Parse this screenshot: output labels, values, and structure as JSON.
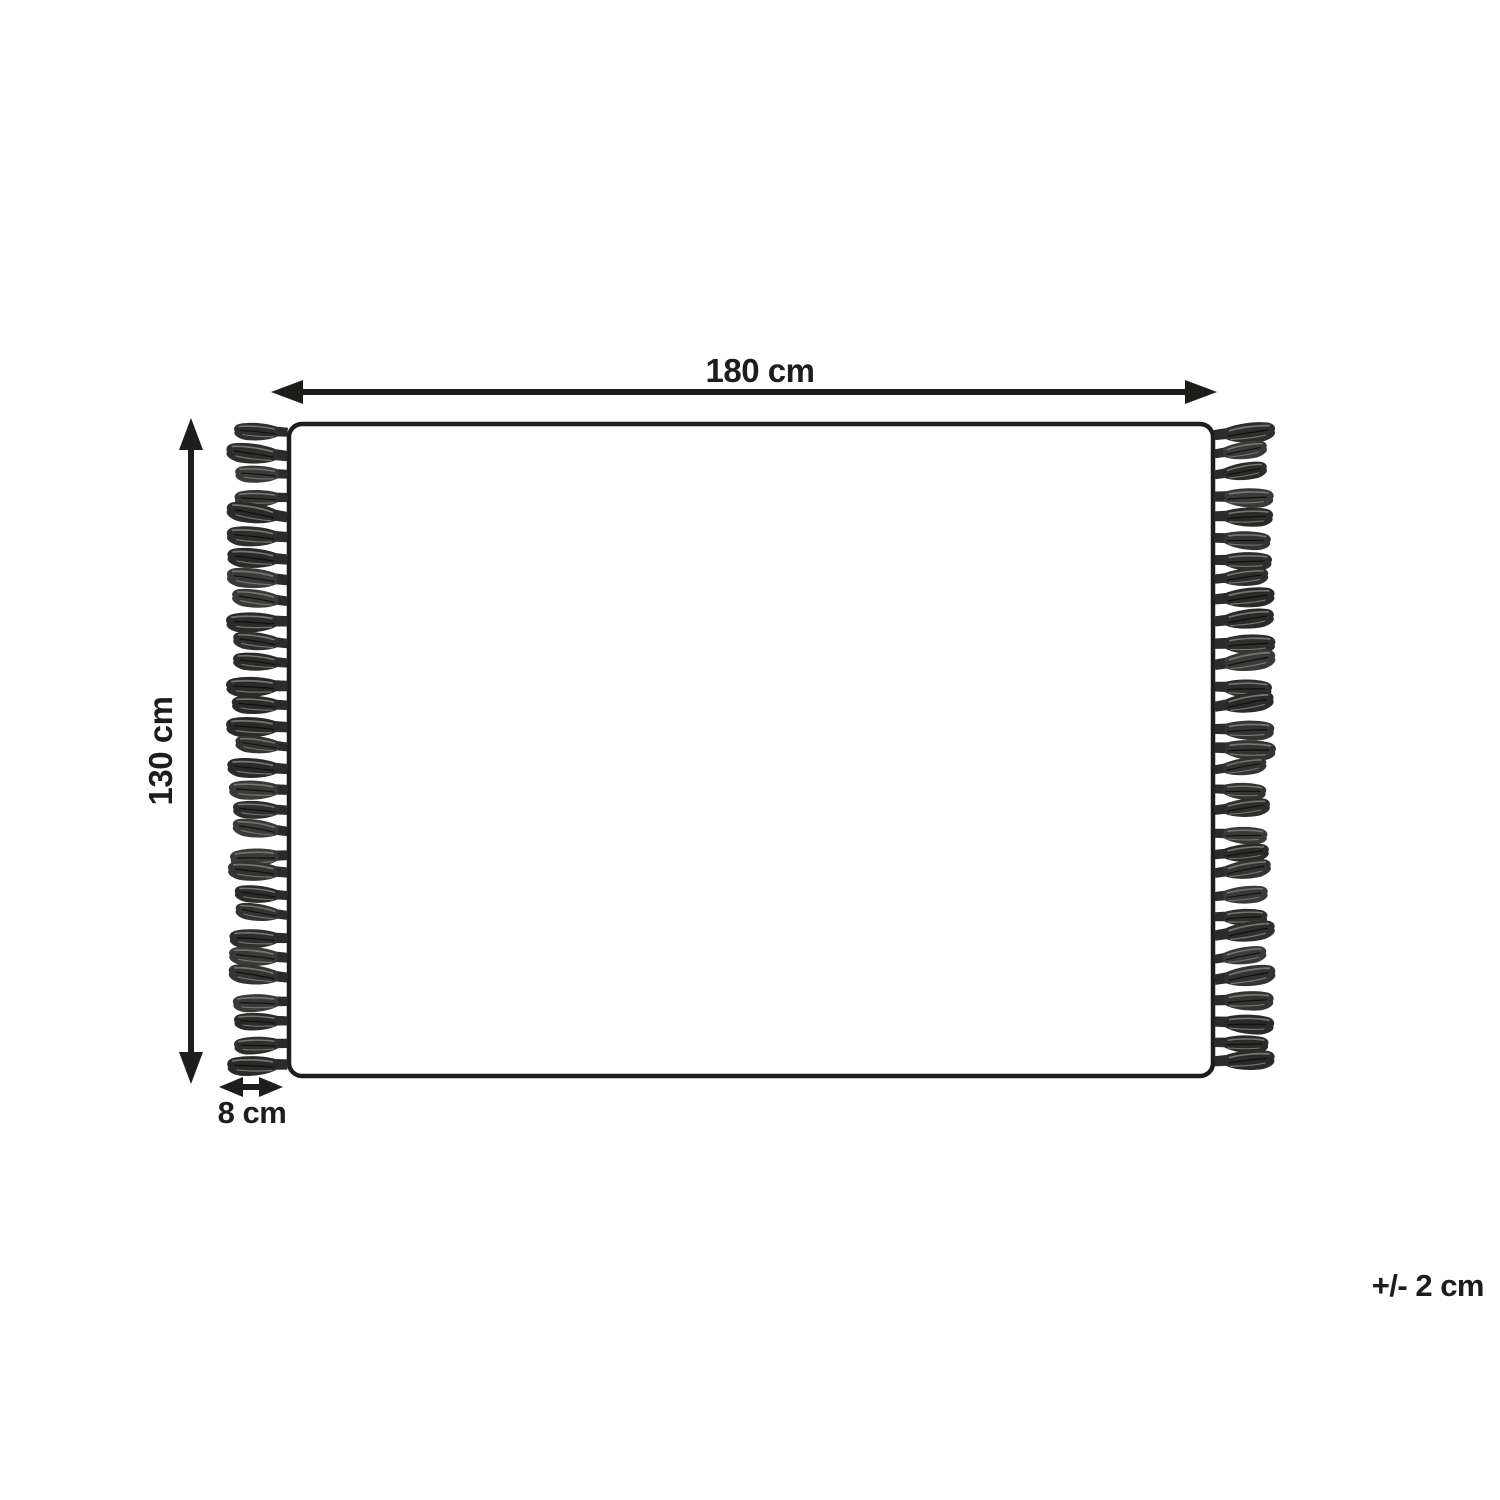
{
  "diagram": {
    "kind": "product-dimension-diagram",
    "labels": {
      "width": "180 cm",
      "height": "130 cm",
      "tassel_length": "8 cm",
      "tolerance": "+/- 2 cm"
    },
    "tassels": {
      "per_side": 31,
      "sides": [
        "left",
        "right"
      ],
      "palette": [
        "#2e2e2c",
        "#3a3a38",
        "#333331",
        "#2a2a28"
      ],
      "knot_color": "#2b2b29",
      "streak_light": "#757573",
      "streak_dark": "#101010"
    },
    "colors": {
      "line": "#1d1d1b",
      "background": "#ffffff"
    }
  }
}
